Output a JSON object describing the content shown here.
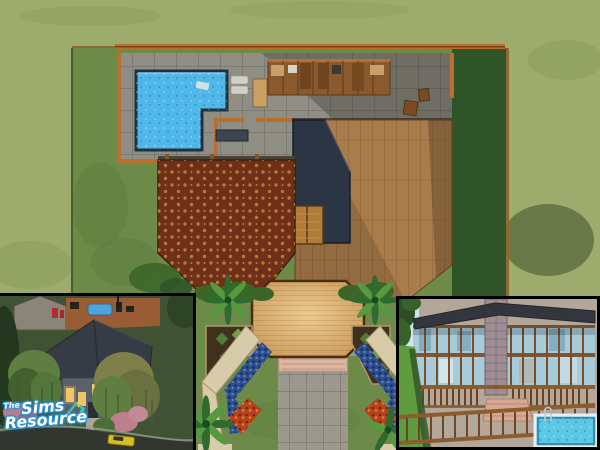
{
  "watermark": {
    "the": "The",
    "sims": "Sims",
    "resource": "Resource"
  },
  "scene": {
    "colors": {
      "grass_outer": "#9dac6c",
      "grass_outer_shade": "#7e9152",
      "grass_lot": "#6d8a48",
      "grass_lot_shade": "#5a7a3e",
      "hedge_dark": "#2f5428",
      "fence": "#b96f2e",
      "fence_dark": "#7a4418",
      "lot_line": "#8a6a30",
      "patio": "#8f8e85",
      "pool_water": "#4fb8e8",
      "pool_edge": "#20303c",
      "pool_light": "#9fdcf4",
      "roof_navy": "#2c3543",
      "roof_navy_edge": "#161e2b",
      "carpet": "#6e3018",
      "carpet_dot": "#c08040",
      "wood": "#a97c4c",
      "door_wood": "#b07c3a",
      "deck": "#c79655",
      "deck_light": "#eccb90",
      "deck_edge": "#4a2c12",
      "path_gray": "#9b998e",
      "steps_pink": "#ddb7a2",
      "path_tan": "#d8cba9",
      "path_tan_edge": "#ab9770",
      "soil": "#40311e",
      "shrub": "#4f7b35",
      "shrub_light": "#6f9b4a",
      "flowers_blue": "#2e4f8e",
      "flowers_red": "#b4421c",
      "palm": "#2e6b2f",
      "palm_light": "#56993e",
      "inset_border": "#000000",
      "night_grass": "#3f5233",
      "night_road": "#31362e",
      "night_sidewalk": "#979d8f",
      "night_roof": "#363c46",
      "night_wall": "#5a606c",
      "night_wall2": "#8a8577",
      "night_patio": "#9a5c35",
      "night_pool": "#4fa3d6",
      "window_glow": "#f2c468",
      "willow_green": "#5e7f41",
      "willow_olive": "#7e7f49",
      "willow_dark": "#44602f",
      "bush_pink": "#bd7f8d",
      "car_yellow": "#d8c020",
      "day_sky": "#cfe3ea",
      "day_tree": "#2c4f26",
      "day_lawn": "#5f9c3d",
      "glass": "#a8cbdc",
      "glass_dark": "#7fa8bc",
      "frame_brown": "#7b4e28",
      "brick": "#9e8d92",
      "day_roof": "#33373d",
      "rail_wood": "#8a5c30",
      "rail_dark": "#6b421f",
      "day_steps": "#d8a794",
      "day_patio": "#b3a79a",
      "day_pool": "#5cc8e6",
      "pool_coping": "#e8eef0",
      "logo_white": "#ffffff",
      "logo_blue": "#2a8fd0",
      "logo_teal": "#3fbfb0",
      "logo_yellow": "#f0d040"
    }
  }
}
